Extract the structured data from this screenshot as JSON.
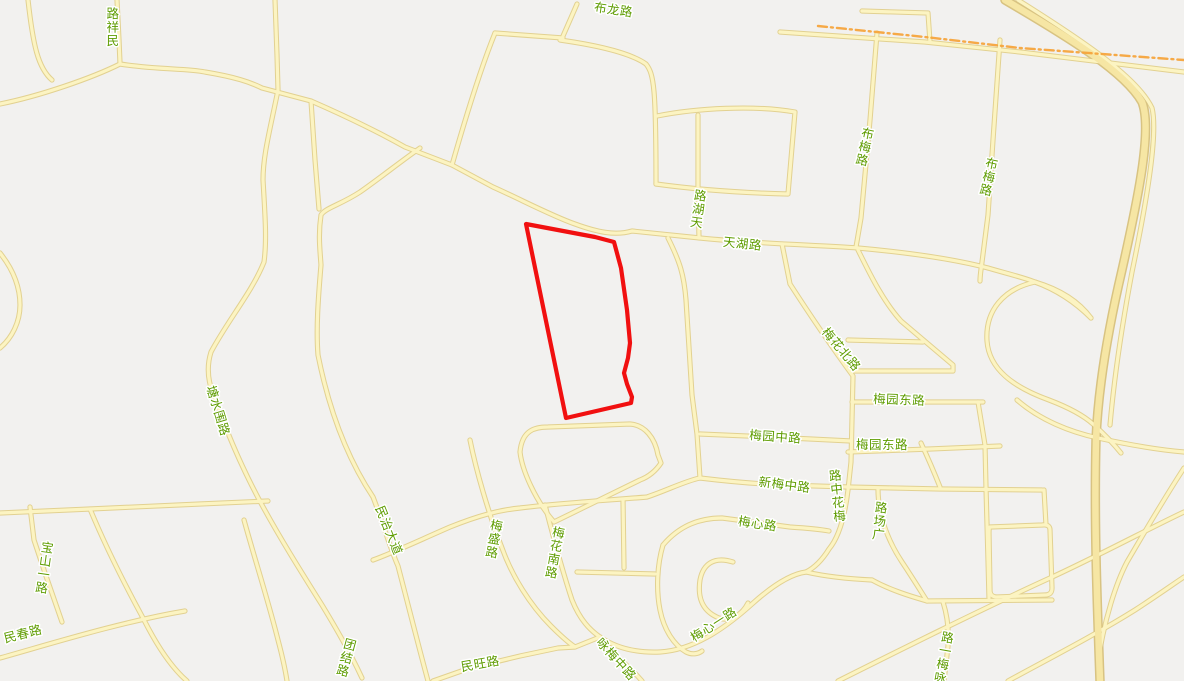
{
  "map": {
    "colors": {
      "background": "#f2f1ef",
      "road_fill": "#fcf4c2",
      "road_casing": "#e2d191",
      "highway_fill": "#f6e6a4",
      "highway_casing": "#d8c382",
      "label_color": "#5e9c00",
      "boundary_color": "#f5a43c",
      "parcel_color": "#f11010"
    },
    "parcel": {
      "d": "M526,224 L595,237 L614,242 L621,268 L627,310 L630,343 L628,358 L624,373 L627,384 L632,397 L631,403 L566,418 Z"
    },
    "boundary": {
      "d": "M818,26 L925,37 L1020,48 L1184,60"
    },
    "roads": [
      {
        "t": "n",
        "d": "M117,0 L119,40 L120,63"
      },
      {
        "t": "n",
        "d": "M28,0 C33,45 38,68 52,80"
      },
      {
        "t": "n",
        "d": "M0,104 C40,96 92,78 120,64 C158,70 185,68 205,72 C235,77 250,82 262,88 L311,101 C350,118 380,133 405,147 L452,165 L493,187 C520,199 552,216 575,224 C597,232 615,236 632,231 L700,238 C760,244 820,245 858,248 C902,252 950,258 988,268"
      },
      {
        "t": "n",
        "d": "M698,115 L698,190 L699,238"
      },
      {
        "t": "n",
        "d": "M560,40 C602,46 632,54 646,64 C654,74 656,88 656,184"
      },
      {
        "t": "n",
        "d": "M656,184 C700,190 748,193 788,194 L795,112 C755,105 697,108 657,116"
      },
      {
        "t": "n",
        "d": "M577,4 L563,36"
      },
      {
        "t": "n",
        "d": "M495,33 L563,38"
      },
      {
        "t": "n",
        "d": "M495,33 C480,70 462,130 452,165"
      },
      {
        "t": "n",
        "d": "M877,33 L870,120 L861,218 L856,247"
      },
      {
        "t": "n",
        "d": "M1000,40 L993,140 L988,215 L982,262 C981,270 980,275 980,281"
      },
      {
        "t": "n",
        "d": "M862,11 L928,13 L930,42"
      },
      {
        "t": "n",
        "d": "M780,32 L925,42 L1020,52 L1184,72"
      },
      {
        "t": "n",
        "d": "M782,244 L790,284 C810,315 831,346 853,376 L851,462 L848,490 C845,515 839,537 829,549 C821,562 812,569 806,572"
      },
      {
        "t": "n",
        "d": "M858,250 C868,270 882,300 901,321 L953,365 L953,371 L853,371"
      },
      {
        "t": "n",
        "d": "M848,340 L923,342"
      },
      {
        "t": "n",
        "d": "M852,402 L983,402"
      },
      {
        "t": "n",
        "d": "M848,452 L930,449 L1000,446"
      },
      {
        "t": "n",
        "d": "M700,434 L770,437 L851,441"
      },
      {
        "t": "n",
        "d": "M668,238 C680,262 684,275 686,300 L692,395 L697,434 L700,478"
      },
      {
        "t": "n",
        "d": "M373,560 C395,552 420,540 450,527 C480,515 500,510 520,508 C560,503 612,500 647,497 C668,490 685,481 700,478 C725,481 755,484 785,485 L848,487 L940,489 L1042,490"
      },
      {
        "t": "n",
        "d": "M921,443 C928,458 934,472 940,487"
      },
      {
        "t": "n",
        "d": "M878,489 C878,512 886,538 902,562 C912,577 920,590 927,601"
      },
      {
        "t": "n",
        "d": "M520,452 C522,430 535,427 548,427 L630,424 C645,425 655,438 658,455 L661,463 C655,472 648,477 640,480 L554,522 C535,500 522,470 520,452 Z"
      },
      {
        "t": "n",
        "d": "M623,500 L624,568"
      },
      {
        "t": "n",
        "d": "M577,572 L655,574"
      },
      {
        "t": "n",
        "d": "M663,545 C657,565 656,590 660,610 C664,630 674,645 686,652 C692,655 698,654 702,651"
      },
      {
        "t": "n",
        "d": "M663,545 C680,525 700,518 722,518 L790,527 C805,528 818,529 829,531"
      },
      {
        "t": "n",
        "d": "M733,562 C714,556 703,564 700,580 C697,600 704,612 719,618 C730,622 742,615 748,603"
      },
      {
        "t": "n",
        "d": "M600,637 C616,648 636,653 660,652 C692,650 722,631 752,604 C772,586 790,574 806,572"
      },
      {
        "t": "n",
        "d": "M806,572 C828,577 850,579 872,580"
      },
      {
        "t": "n",
        "d": "M872,580 C890,590 910,596 927,601"
      },
      {
        "t": "n",
        "d": "M433,681 L470,668 L520,656 L558,648 L575,647 L600,637"
      },
      {
        "t": "n",
        "d": "M600,637 L616,656 L632,670 L642,681"
      },
      {
        "t": "n",
        "d": "M545,505 C552,532 561,567 572,600 C580,620 590,630 600,637"
      },
      {
        "t": "n",
        "d": "M470,440 C476,470 488,512 502,548 C512,576 530,605 551,626 C558,633 566,641 575,647"
      },
      {
        "t": "n",
        "d": "M275,0 L277,55 L278,90 C270,130 263,155 263,180 C265,215 267,240 264,262 C252,292 228,320 211,352 C206,368 208,382 214,396 C228,436 244,472 262,505 C280,538 300,570 322,605 C336,628 350,652 362,678"
      },
      {
        "t": "n",
        "d": "M311,101 L315,160 L319,209"
      },
      {
        "t": "n",
        "d": "M420,148 C400,162 380,178 360,192 C340,205 325,208 321,215 C318,235 320,250 321,265 C318,300 316,330 318,355 C328,405 345,455 373,497 C382,520 390,548 398,566 C410,612 419,648 428,681"
      },
      {
        "t": "n",
        "d": "M244,520 C255,560 268,600 278,640 C282,655 285,668 287,681"
      },
      {
        "t": "n",
        "d": "M0,253 C12,268 20,285 20,305 C20,322 12,338 0,348"
      },
      {
        "t": "n",
        "d": "M0,513 L90,509 L200,504 L268,501"
      },
      {
        "t": "n",
        "d": "M30,507 L34,540 L46,576 L62,622"
      },
      {
        "t": "n",
        "d": "M90,509 C105,545 125,585 143,618 C158,648 172,668 187,681"
      },
      {
        "t": "n",
        "d": "M0,658 C50,644 120,622 185,611"
      },
      {
        "t": "n",
        "d": "M978,402 L985,445 L986,488"
      },
      {
        "t": "n",
        "d": "M986,488 L988,560 L989,598"
      },
      {
        "t": "n",
        "d": "M1044,490 L1046,525"
      },
      {
        "t": "n",
        "d": "M990,527 L1042,525 Q1050,524 1050,530 L1052,588 Q1052,595 1045,595 L997,597 Q990,597 990,590 L989,533 Q989,527 990,527"
      },
      {
        "t": "n",
        "d": "M927,601 L1052,600"
      },
      {
        "t": "n",
        "d": "M943,602 C948,618 950,635 947,655 L944,681"
      },
      {
        "t": "n",
        "d": "M1017,400 C1040,420 1070,432 1098,438 C1130,445 1160,450 1184,452"
      },
      {
        "t": "n",
        "d": "M988,268 C1005,273 1022,277 1035,282 C1062,290 1080,303 1091,318"
      },
      {
        "t": "n",
        "d": "M1091,318 C1075,302 1057,290 1035,282 C1003,289 985,311 987,341 C989,369 1013,387 1049,400 C1070,408 1084,416 1093,424 C1103,433 1113,443 1121,453"
      },
      {
        "t": "n",
        "d": "M1184,468 C1160,505 1140,540 1127,562 C1115,585 1105,620 1100,650"
      },
      {
        "t": "n",
        "d": "M838,681 C900,650 980,610 1050,578 C1100,555 1150,528 1184,512"
      },
      {
        "t": "n",
        "d": "M1008,681 C1050,658 1095,635 1135,610 C1155,597 1172,585 1184,577"
      },
      {
        "t": "n",
        "d": "M1018,0 C1085,42 1138,78 1152,108 C1158,132 1148,195 1132,272 C1122,325 1114,380 1110,425"
      },
      {
        "t": "h",
        "d": "M1005,0 C1070,38 1125,72 1142,102 C1152,128 1140,190 1122,270 C1108,330 1098,390 1096,440 C1094,520 1097,600 1100,681"
      }
    ],
    "labels": [
      {
        "text": "布龙路",
        "x": 613,
        "y": 14,
        "rot": 8,
        "mode": "h"
      },
      {
        "text": "民祥路",
        "x": 113,
        "y": 18,
        "rot": 0,
        "mode": "vr"
      },
      {
        "text": "天湖路",
        "x": 700,
        "y": 200,
        "rot": 8,
        "mode": "vr"
      },
      {
        "text": "天湖路",
        "x": 742,
        "y": 248,
        "rot": 6,
        "mode": "h"
      },
      {
        "text": "布梅路",
        "x": 867,
        "y": 138,
        "rot": 12,
        "mode": "v"
      },
      {
        "text": "布梅路",
        "x": 991,
        "y": 168,
        "rot": 12,
        "mode": "v"
      },
      {
        "text": "梅花北路",
        "x": 838,
        "y": 352,
        "rot": 50,
        "mode": "h"
      },
      {
        "text": "梅园东路",
        "x": 899,
        "y": 404,
        "rot": 2,
        "mode": "h"
      },
      {
        "text": "梅园东路",
        "x": 882,
        "y": 449,
        "rot": 0,
        "mode": "h"
      },
      {
        "text": "梅园中路",
        "x": 775,
        "y": 441,
        "rot": 4,
        "mode": "h"
      },
      {
        "text": "新梅中路",
        "x": 784,
        "y": 489,
        "rot": 7,
        "mode": "h"
      },
      {
        "text": "梅花中路",
        "x": 836,
        "y": 480,
        "rot": -6,
        "mode": "vr"
      },
      {
        "text": "广场路",
        "x": 881,
        "y": 512,
        "rot": 6,
        "mode": "vr"
      },
      {
        "text": "梅心路",
        "x": 757,
        "y": 528,
        "rot": 8,
        "mode": "h"
      },
      {
        "text": "梅心一路",
        "x": 716,
        "y": 628,
        "rot": -33,
        "mode": "h"
      },
      {
        "text": "民治大道",
        "x": 385,
        "y": 532,
        "rot": 68,
        "mode": "h"
      },
      {
        "text": "塘水围路",
        "x": 214,
        "y": 412,
        "rot": 73,
        "mode": "h"
      },
      {
        "text": "梅盛路",
        "x": 496,
        "y": 530,
        "rot": 10,
        "mode": "v"
      },
      {
        "text": "梅花南路",
        "x": 558,
        "y": 537,
        "rot": 10,
        "mode": "v"
      },
      {
        "text": "团结路",
        "x": 349,
        "y": 649,
        "rot": 15,
        "mode": "v"
      },
      {
        "text": "民旺路",
        "x": 481,
        "y": 668,
        "rot": -10,
        "mode": "h"
      },
      {
        "text": "民春路",
        "x": 24,
        "y": 638,
        "rot": -14,
        "mode": "h"
      },
      {
        "text": "宝山一路",
        "x": 47,
        "y": 552,
        "rot": 8,
        "mode": "v"
      },
      {
        "text": "咏梅中路",
        "x": 613,
        "y": 662,
        "rot": 48,
        "mode": "h"
      },
      {
        "text": "咏梅一路",
        "x": 947,
        "y": 642,
        "rot": 10,
        "mode": "vr"
      }
    ]
  }
}
